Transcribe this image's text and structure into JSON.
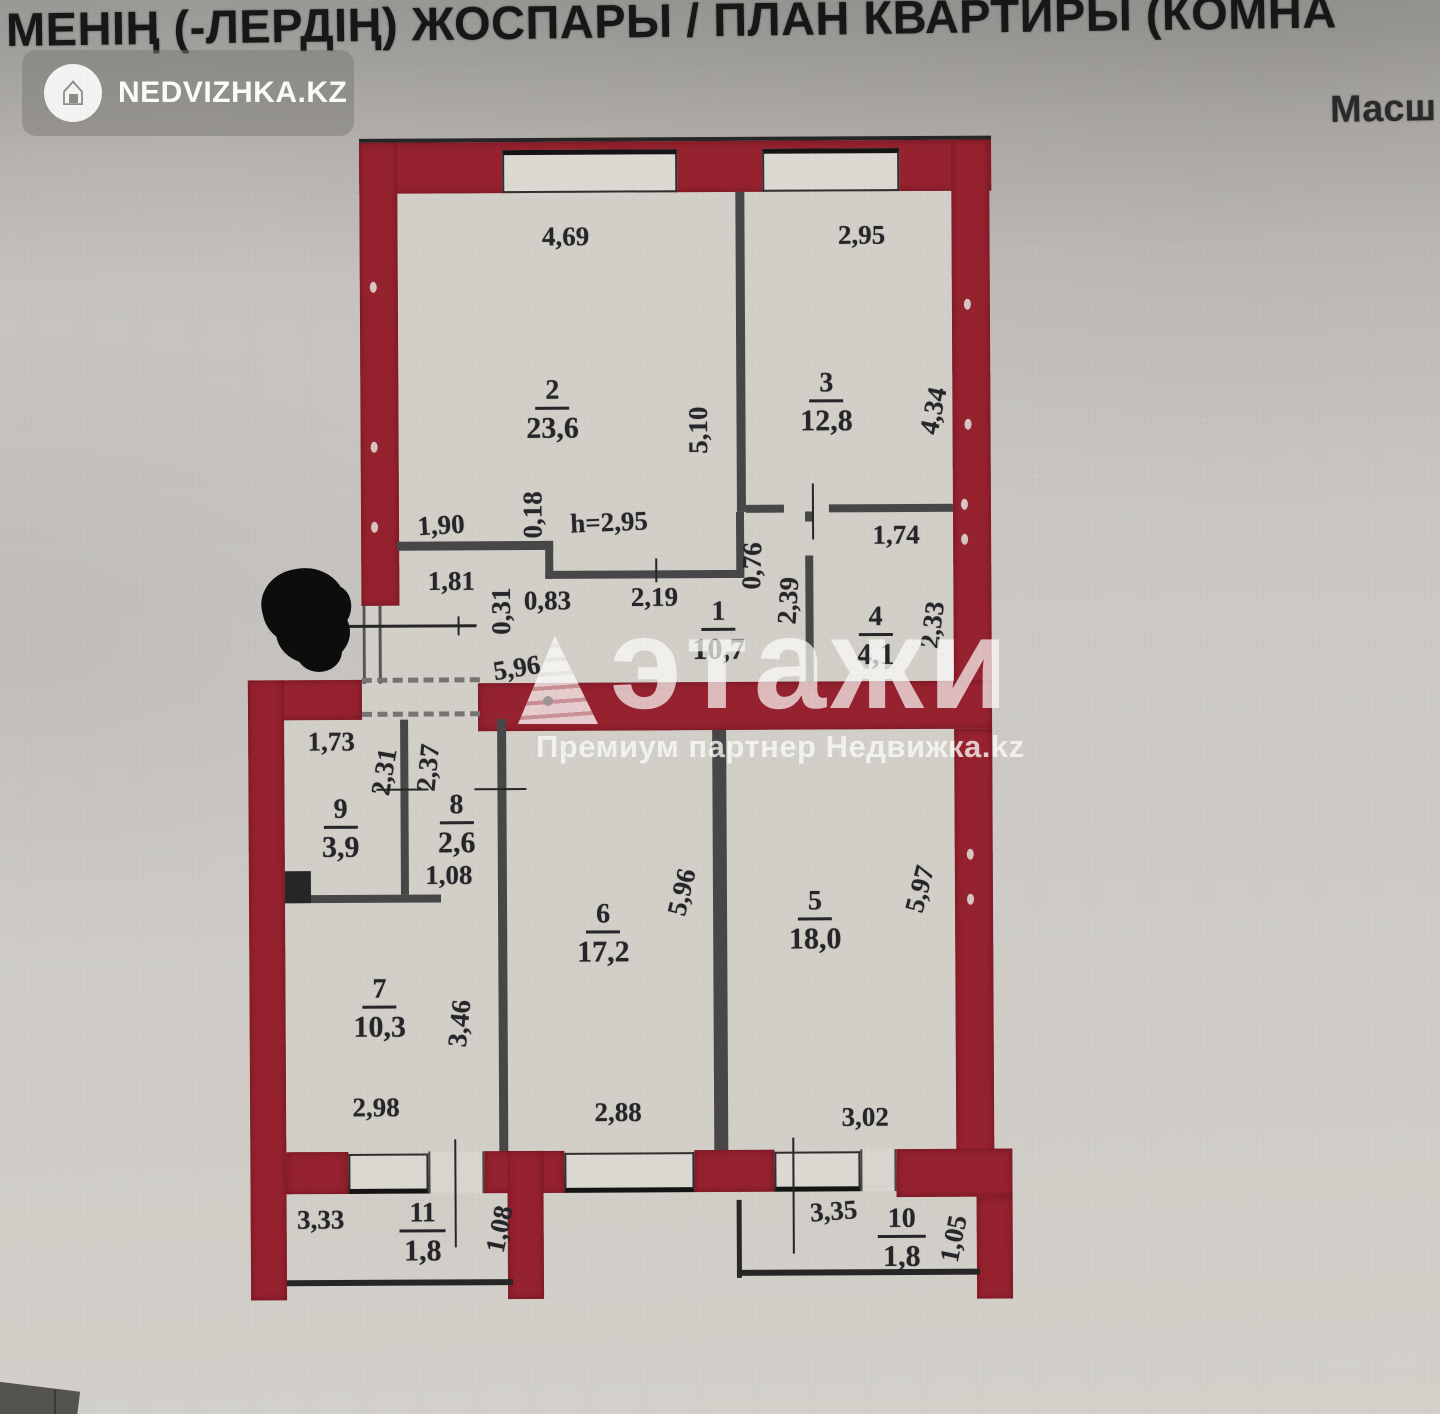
{
  "header": {
    "title": "МЕНІҢ (-ЛЕРДІҢ) ЖОСПАРЫ / ПЛАН КВАРТИРЫ (КОМНА",
    "scale_label": "Масш"
  },
  "logo": {
    "text": "NEDVIZHKA.KZ",
    "icon": "house-icon"
  },
  "watermark": {
    "brand": "этажи",
    "subtitle": "Премиум партнер Недвижка.kz",
    "icon": "etazhi-triangle-logo"
  },
  "plan": {
    "ceiling_height": "h=2,95",
    "rooms": {
      "r1": {
        "number": "1",
        "area": "10,7"
      },
      "r2": {
        "number": "2",
        "area": "23,6"
      },
      "r3": {
        "number": "3",
        "area": "12,8"
      },
      "r4": {
        "number": "4",
        "area": "4,1"
      },
      "r5": {
        "number": "5",
        "area": "18,0"
      },
      "r6": {
        "number": "6",
        "area": "17,2"
      },
      "r7": {
        "number": "7",
        "area": "10,3"
      },
      "r8": {
        "number": "8",
        "area": "2,6"
      },
      "r9": {
        "number": "9",
        "area": "3,9"
      },
      "r10": {
        "number": "10",
        "area": "1,8"
      },
      "r11": {
        "number": "11",
        "area": "1,8"
      }
    },
    "dims": {
      "room2_width": "4,69",
      "room2_height": "5,10",
      "room3_width": "2,95",
      "room3_height": "4,34",
      "room4_width": "1,74",
      "room4_height": "2,33",
      "hall_width": "5,96",
      "dim_190": "1,90",
      "dim_181": "1,81",
      "dim_018": "0,18",
      "dim_031": "0,31",
      "dim_083": "0,83",
      "dim_219": "2,19",
      "dim_076": "0,76",
      "dim_239": "2,39",
      "room9_width": "1,73",
      "room9_height": "2,31",
      "room8_height": "2,37",
      "room8_door": "1,08",
      "room6_height": "5,96",
      "room6_width": "2,88",
      "room5_height": "5,97",
      "room5_width": "3,02",
      "room7_height": "3,46",
      "room7_width": "2,98",
      "balcony11_width": "3,33",
      "balcony11_depth": "1,08",
      "balcony10_width": "3,35",
      "balcony10_depth": "1,05"
    }
  },
  "colors": {
    "wall_red": "#96222f",
    "wall_gray": "#474747",
    "window_fill": "#dcd8d2",
    "paper": "#cfccc7",
    "redaction": "#0d0d0d",
    "watermark_white": "rgba(252,252,250,0.72)"
  }
}
